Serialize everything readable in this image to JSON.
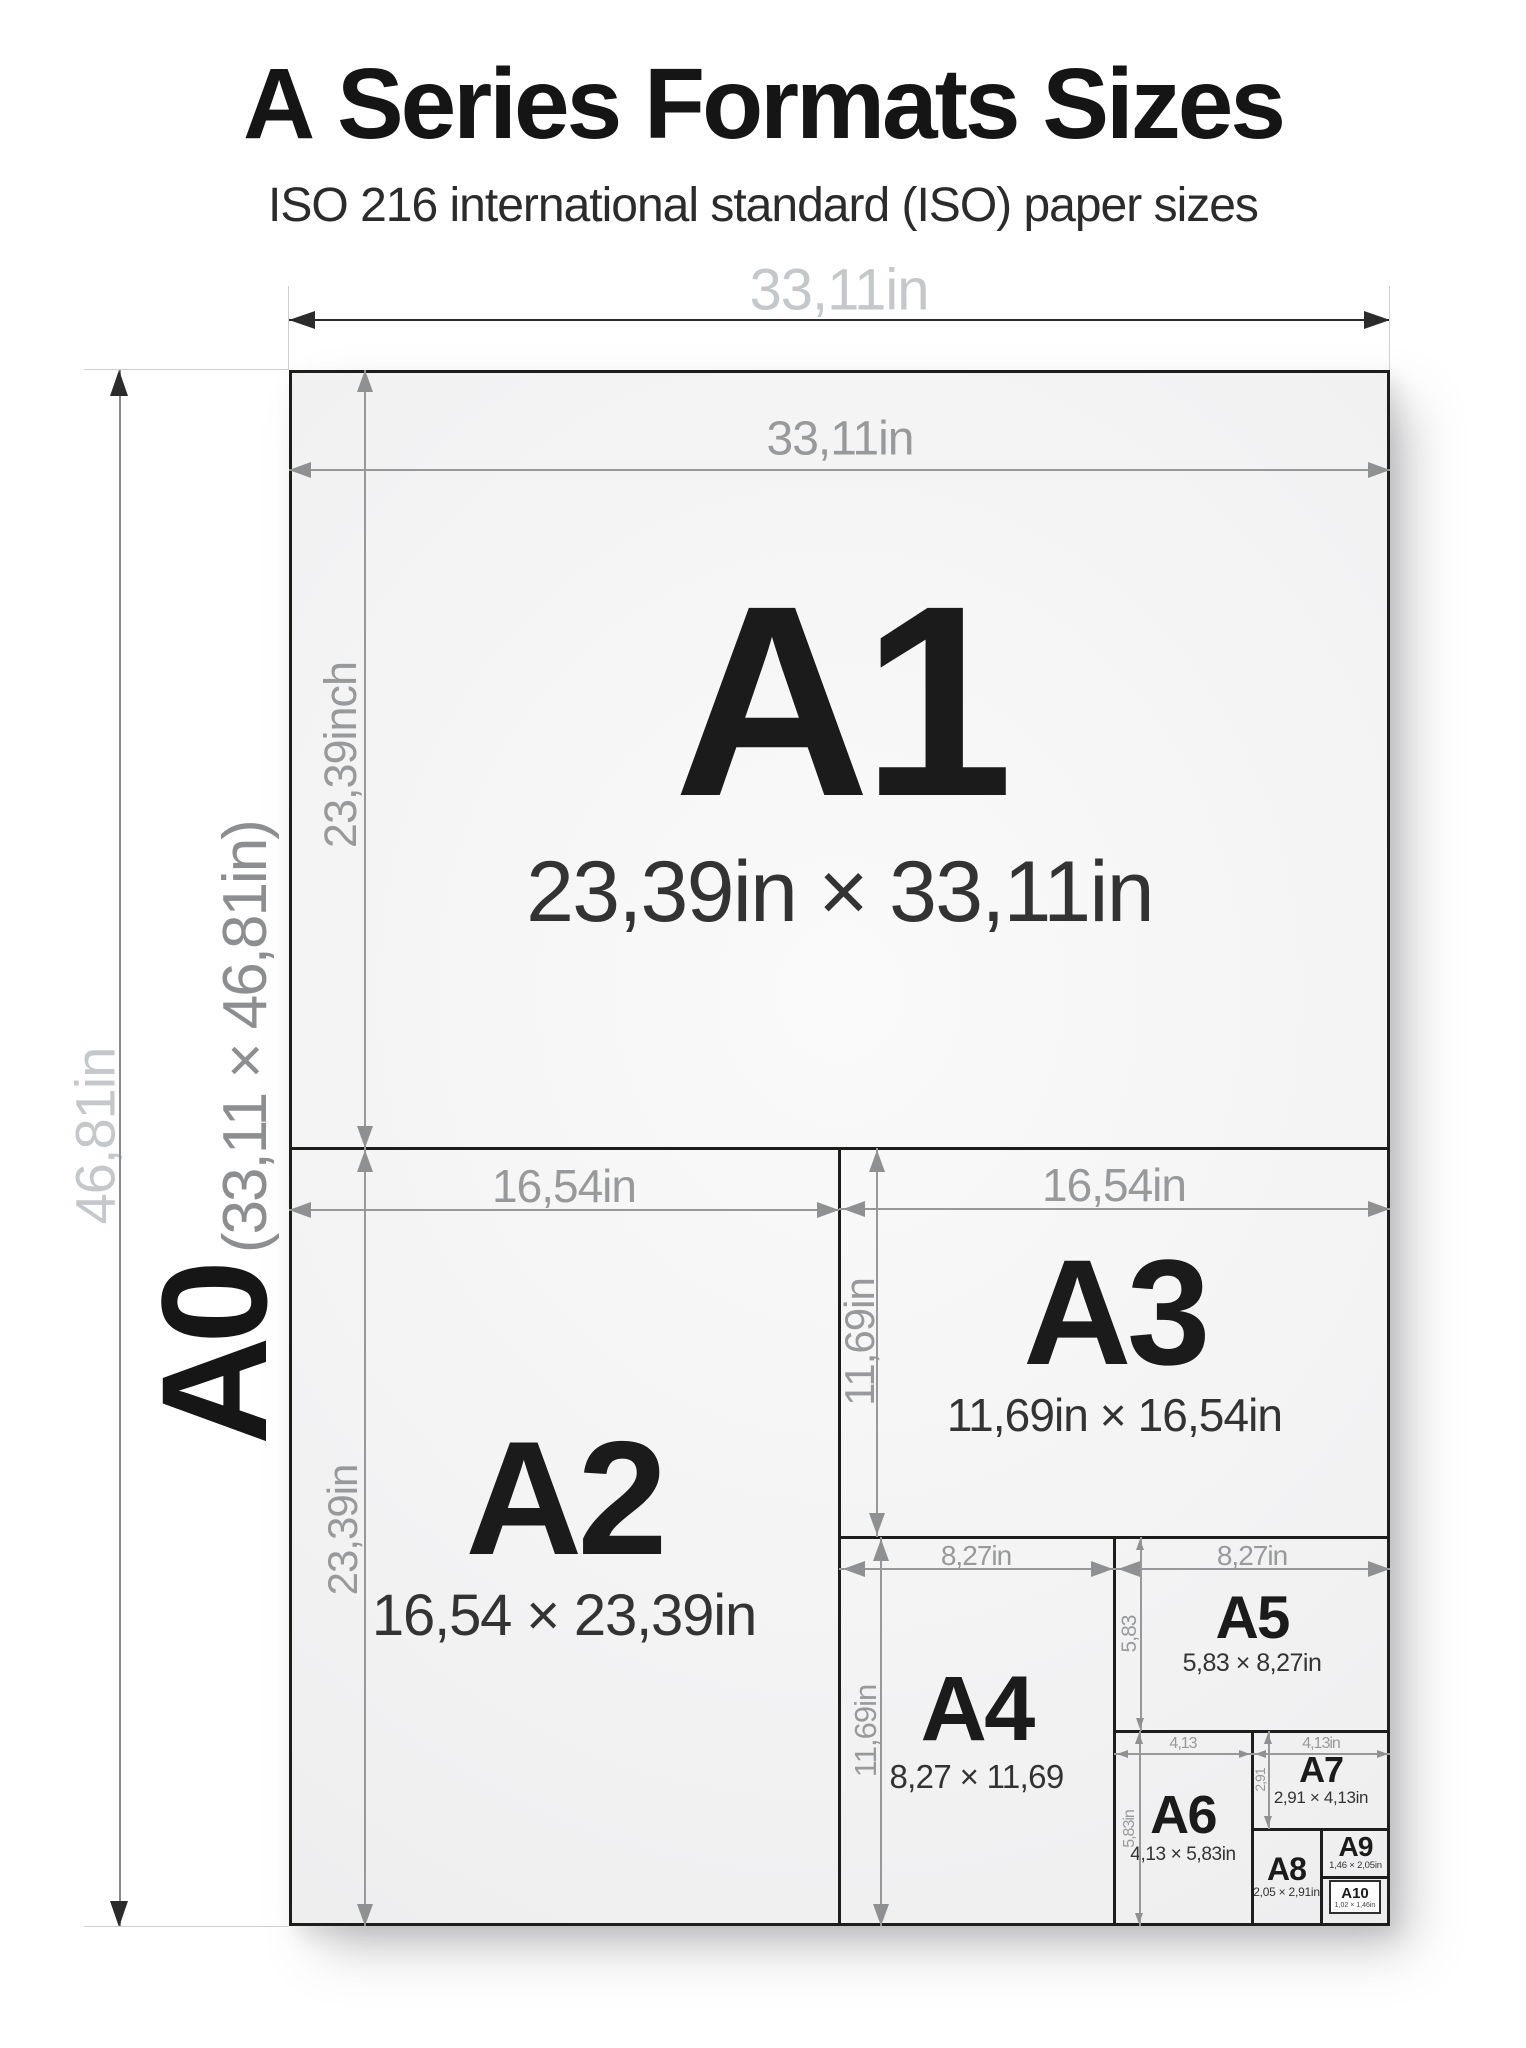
{
  "page": {
    "title_prefix": "A",
    "title_rest": " Series Formats Sizes",
    "subtitle": "ISO 216 international standard (ISO) paper sizes"
  },
  "a0": {
    "code": "A0",
    "dims": "(33,11 × 46,81in)",
    "width_label": "33,11in",
    "height_label": "46,81in"
  },
  "formats": [
    {
      "code": "A1",
      "dims": "23,39in × 33,11in",
      "width_label": "33,11in",
      "height_label": "23,39inch"
    },
    {
      "code": "A2",
      "dims": "16,54 × 23,39in",
      "width_label": "16,54in",
      "height_label": "23,39in"
    },
    {
      "code": "A3",
      "dims": "11,69in × 16,54in",
      "width_label": "16,54in",
      "height_label": "11,69in"
    },
    {
      "code": "A4",
      "dims": "8,27 × 11,69",
      "width_label": "8,27in",
      "height_label": "11,69in"
    },
    {
      "code": "A5",
      "dims": "5,83 × 8,27in",
      "width_label": "8,27in",
      "height_label": "5,83"
    },
    {
      "code": "A6",
      "dims": "4,13 × 5,83in",
      "width_label": "4,13",
      "height_label": "5,83in"
    },
    {
      "code": "A7",
      "dims": "2,91 × 4,13in",
      "width_label": "4,13in",
      "height_label": "2,91"
    },
    {
      "code": "A8",
      "dims": "2,05 × 2,91in"
    },
    {
      "code": "A9",
      "dims": "1,46 × 2,05in"
    },
    {
      "code": "A10",
      "dims": "1,02 × 1,46in"
    }
  ],
  "colors": {
    "ink": "#1d1d1b",
    "dim_gray": "#97999b",
    "light_gray": "#c5c8ca",
    "paper": "#f2f2f3"
  }
}
